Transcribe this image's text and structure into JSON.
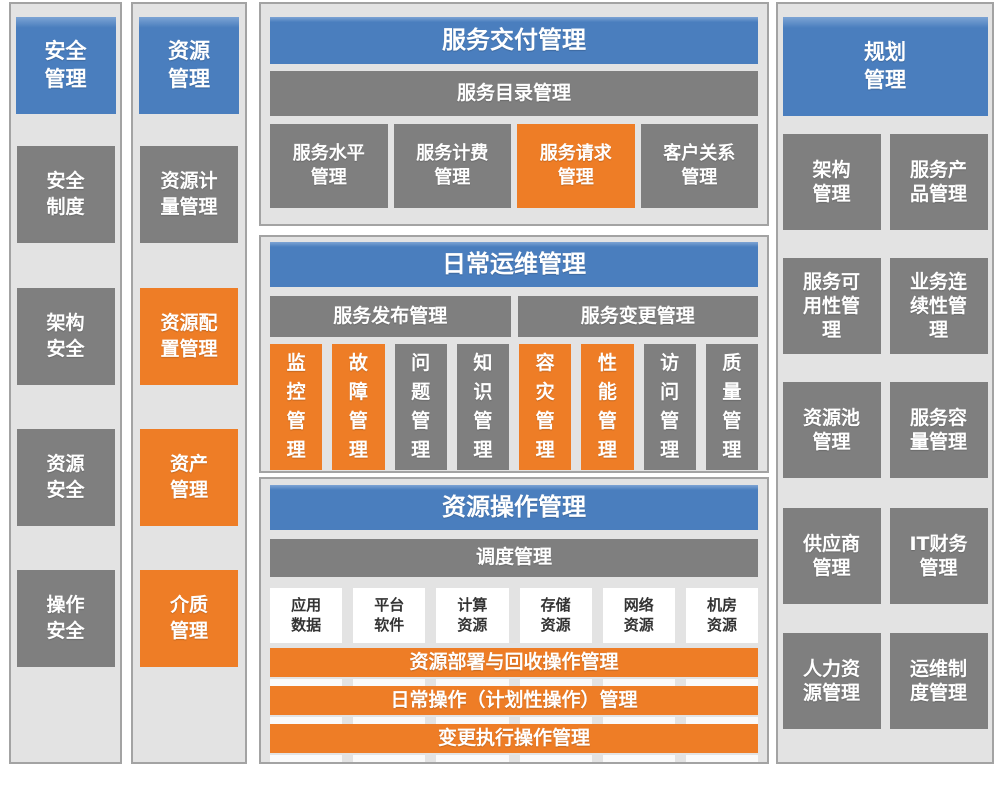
{
  "colors": {
    "blue": "#4A7EBE",
    "orange": "#EE7D26",
    "gray": "#7F7F7F",
    "panel-bg": "#E3E3E3",
    "panel-border": "#A3A3A3",
    "white-box-bg": "#FFFFFF",
    "white-box-text": "#333333"
  },
  "security_column": {
    "header": "安全\n管理",
    "items": [
      {
        "label": "安全\n制度",
        "color": "gray"
      },
      {
        "label": "架构\n安全",
        "color": "gray"
      },
      {
        "label": "资源\n安全",
        "color": "gray"
      },
      {
        "label": "操作\n安全",
        "color": "gray"
      }
    ]
  },
  "resource_column": {
    "header": "资源\n管理",
    "items": [
      {
        "label": "资源计\n量管理",
        "color": "gray"
      },
      {
        "label": "资源配\n置管理",
        "color": "orange"
      },
      {
        "label": "资产\n管理",
        "color": "orange"
      },
      {
        "label": "介质\n管理",
        "color": "orange"
      }
    ]
  },
  "service_delivery": {
    "title": "服务交付管理",
    "subtitle": "服务目录管理",
    "items": [
      {
        "label": "服务水平\n管理",
        "color": "gray"
      },
      {
        "label": "服务计费\n管理",
        "color": "gray"
      },
      {
        "label": "服务请求\n管理",
        "color": "orange"
      },
      {
        "label": "客户关系\n管理",
        "color": "gray"
      }
    ]
  },
  "daily_operations": {
    "title": "日常运维管理",
    "group_left": "服务发布管理",
    "group_right": "服务变更管理",
    "items": [
      {
        "label": "监\n控\n管\n理",
        "color": "orange"
      },
      {
        "label": "故\n障\n管\n理",
        "color": "orange"
      },
      {
        "label": "问\n题\n管\n理",
        "color": "gray"
      },
      {
        "label": "知\n识\n管\n理",
        "color": "gray"
      },
      {
        "label": "容\n灾\n管\n理",
        "color": "orange"
      },
      {
        "label": "性\n能\n管\n理",
        "color": "orange"
      },
      {
        "label": "访\n问\n管\n理",
        "color": "gray"
      },
      {
        "label": "质\n量\n管\n理",
        "color": "gray"
      }
    ]
  },
  "resource_operations": {
    "title": "资源操作管理",
    "subtitle": "调度管理",
    "resources": [
      "应用\n数据",
      "平台\n软件",
      "计算\n资源",
      "存储\n资源",
      "网络\n资源",
      "机房\n资源"
    ],
    "bars": [
      "资源部署与回收操作管理",
      "日常操作（计划性操作）管理",
      "变更执行操作管理"
    ]
  },
  "planning_column": {
    "header": "规划\n管理",
    "rows": [
      [
        "架构\n管理",
        "服务产\n品管理"
      ],
      [
        "服务可\n用性管\n理",
        "业务连\n续性管\n理"
      ],
      [
        "资源池\n管理",
        "服务容\n量管理"
      ],
      [
        "供应商\n管理",
        "IT财务\n管理"
      ],
      [
        "人力资\n源管理",
        "运维制\n度管理"
      ]
    ]
  }
}
